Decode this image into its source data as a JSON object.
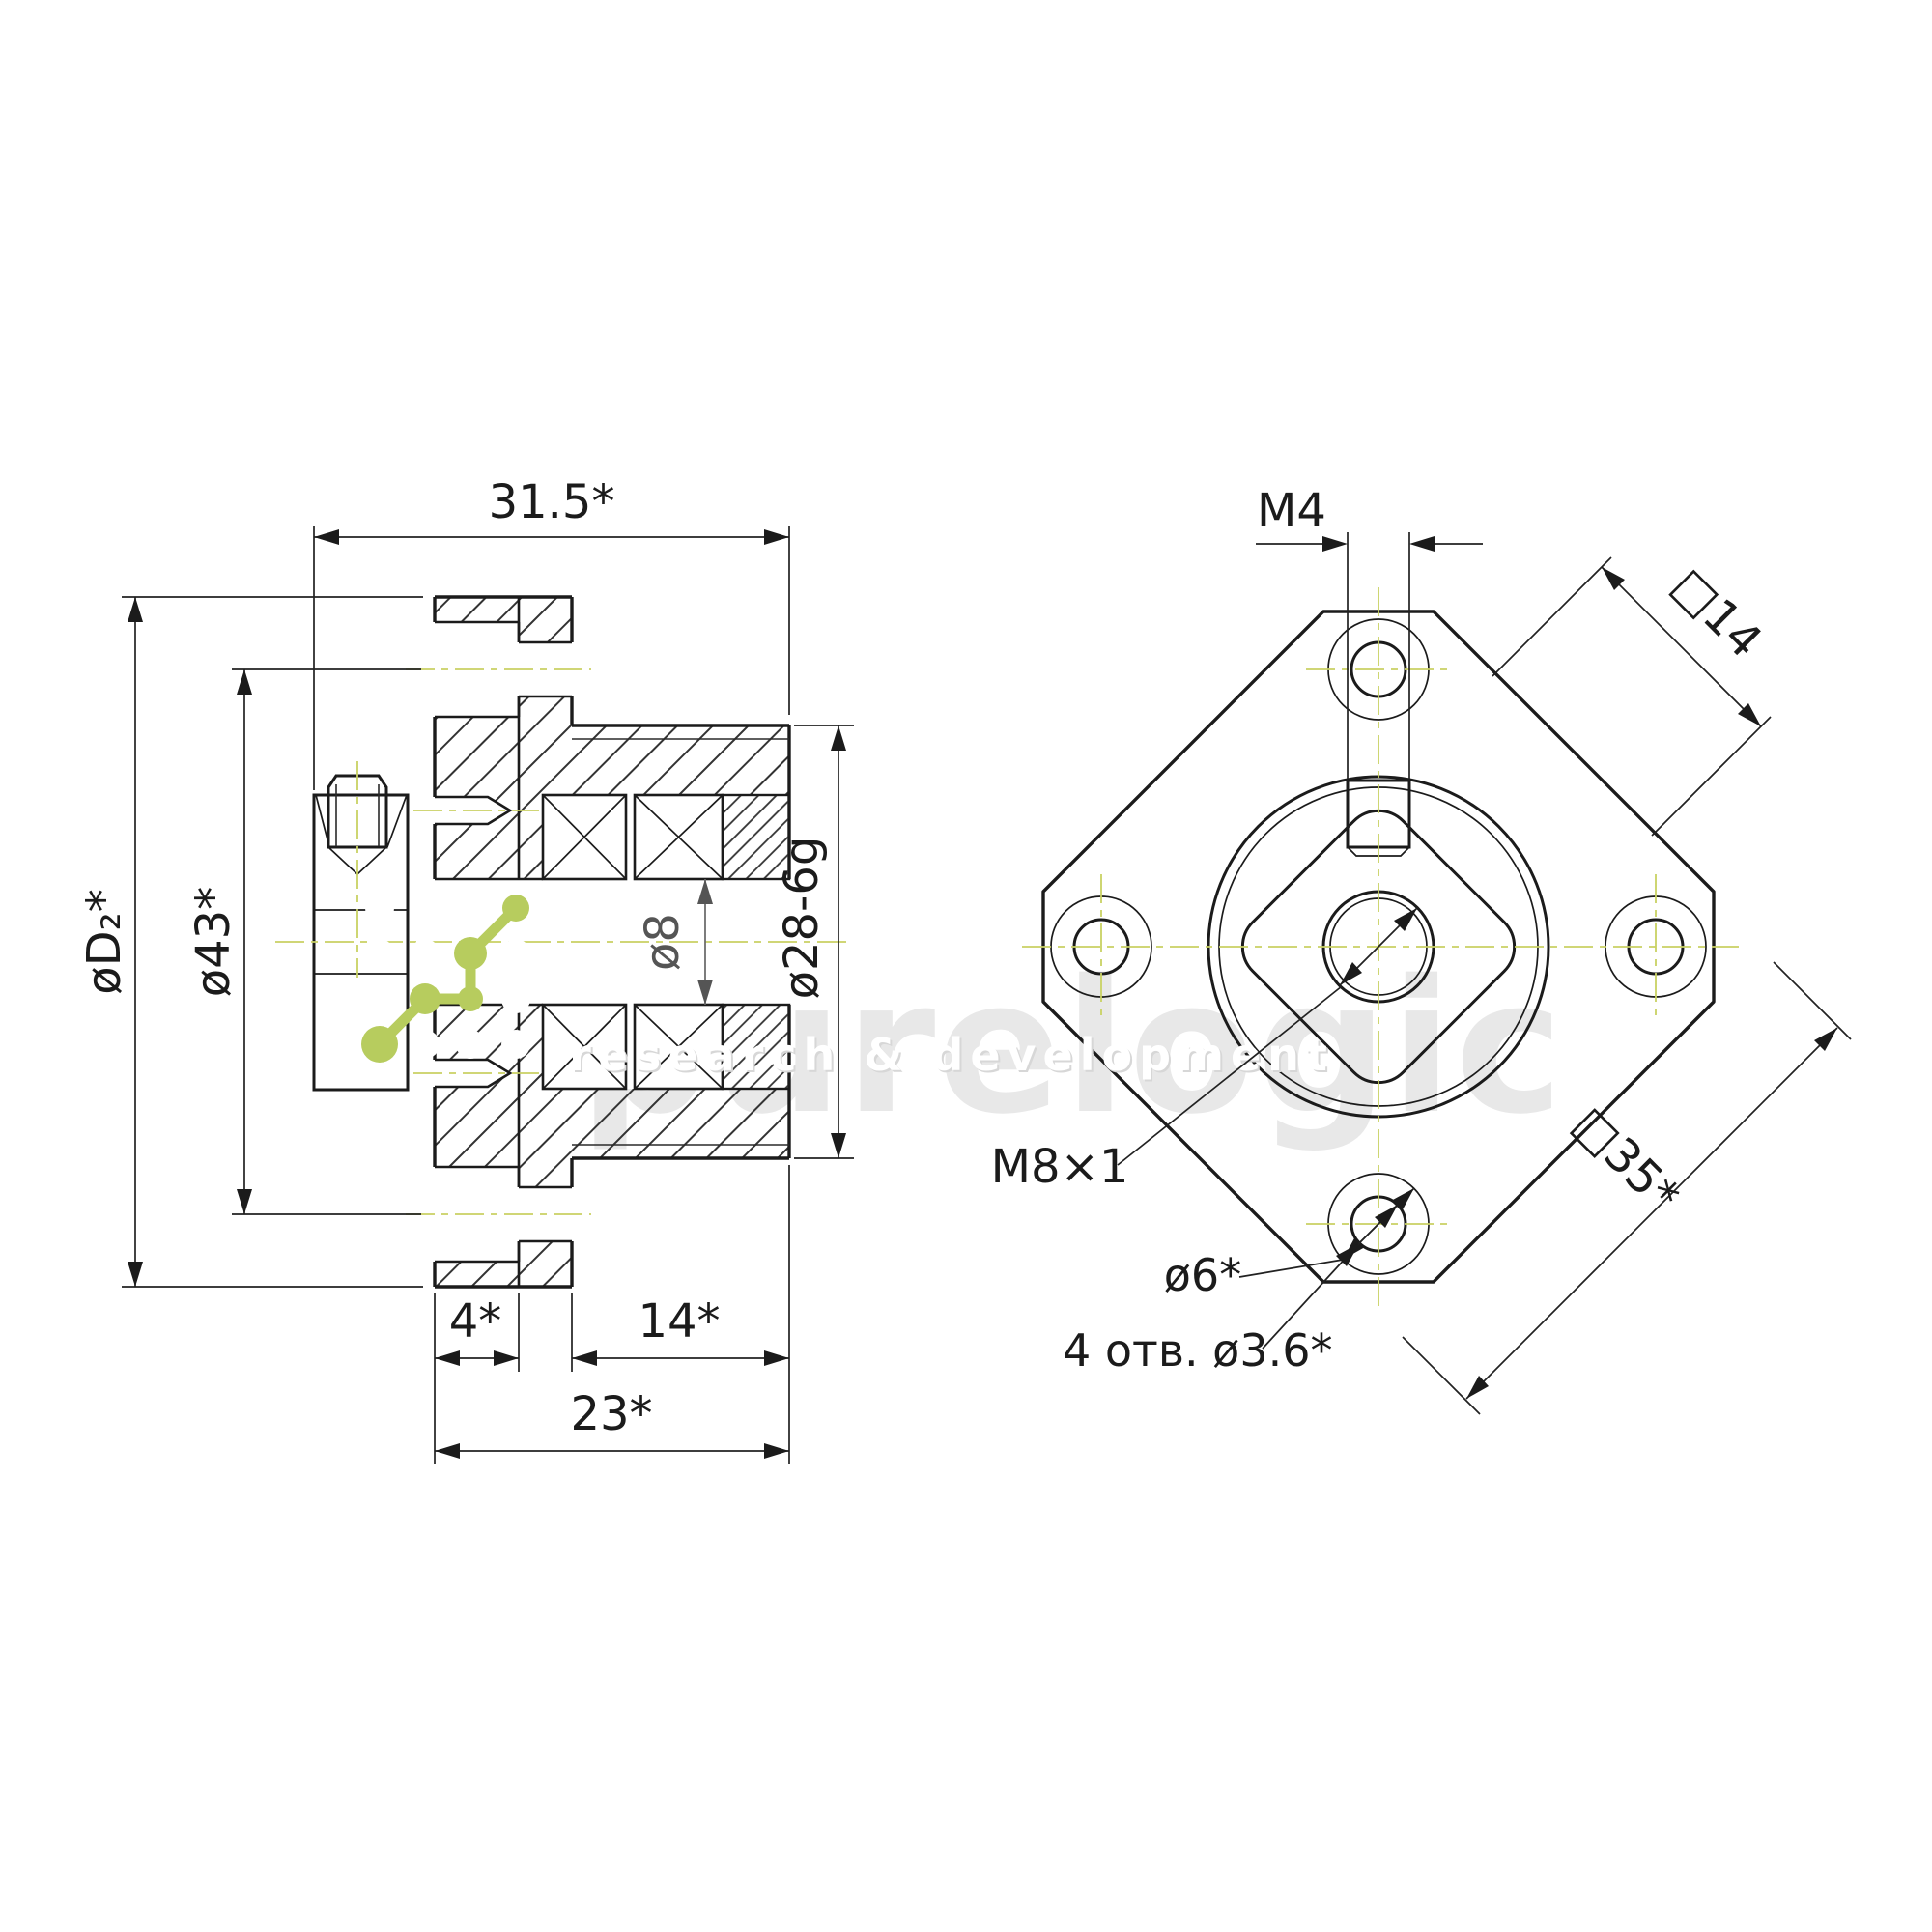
{
  "watermark": {
    "brand": "purelogic",
    "tagline": "research & development"
  },
  "left": {
    "dims": {
      "overall_width": "31.5*",
      "flange_diameter": "øD₂*",
      "bolt_circle_diameter": "ø43*",
      "bore_diameter": "ø8",
      "pilot_diameter": "ø28-6g",
      "flange_thickness": "4*",
      "pilot_length": "14*",
      "body_length": "23*"
    }
  },
  "front": {
    "dims": {
      "set_screw_thread": "M4",
      "corner_flat_square": "□14",
      "center_thread": "M8×1",
      "counterbore_diameter": "ø6*",
      "mounting_holes_note": "4 отв. ø3.6*",
      "flange_square": "□35*"
    }
  },
  "colors": {
    "line": "#1b1b1b",
    "centerline": "#c9d163",
    "molecule_green": "#b7cc5e",
    "watermark_gray": "#e8e8e8",
    "bore_dim_gray": "#666666"
  }
}
